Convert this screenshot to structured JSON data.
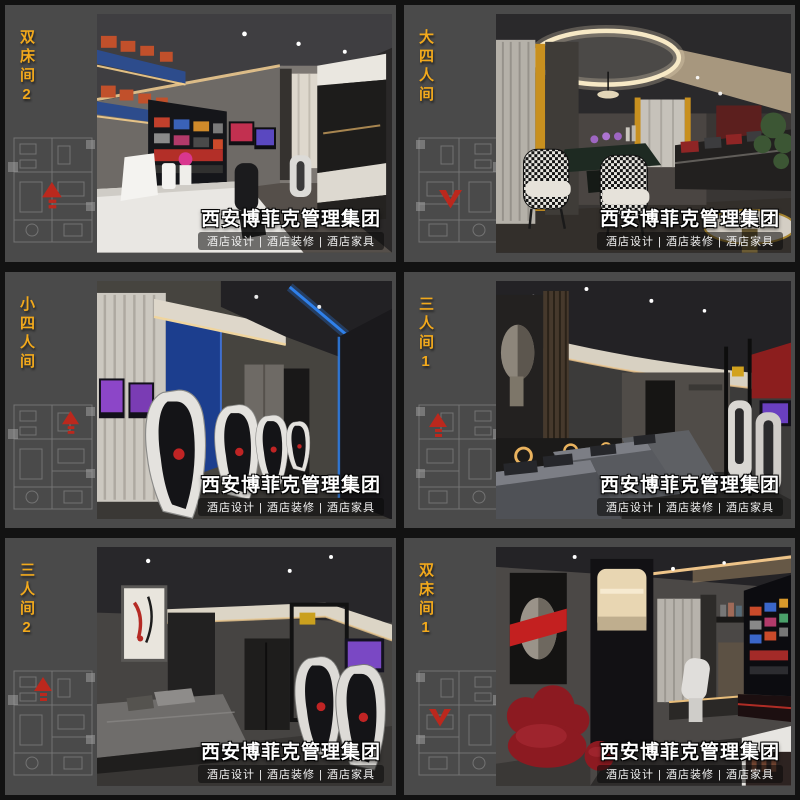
{
  "watermark": {
    "title": "西安博菲克管理集团",
    "subtitle": "酒店设计 | 酒店装修 | 酒店家具"
  },
  "rooms": [
    {
      "label": "双床间2"
    },
    {
      "label": "大四人间"
    },
    {
      "label": "小四人间"
    },
    {
      "label": "三人间1"
    },
    {
      "label": "三人间2"
    },
    {
      "label": "双床间1"
    }
  ],
  "colors": {
    "room_label_yellow": "#f2a91c",
    "plan_arrow_red": "#bb281d",
    "card_background": "#4a4a4a",
    "page_background": "#121212",
    "watermark_text": "#ffffff"
  }
}
